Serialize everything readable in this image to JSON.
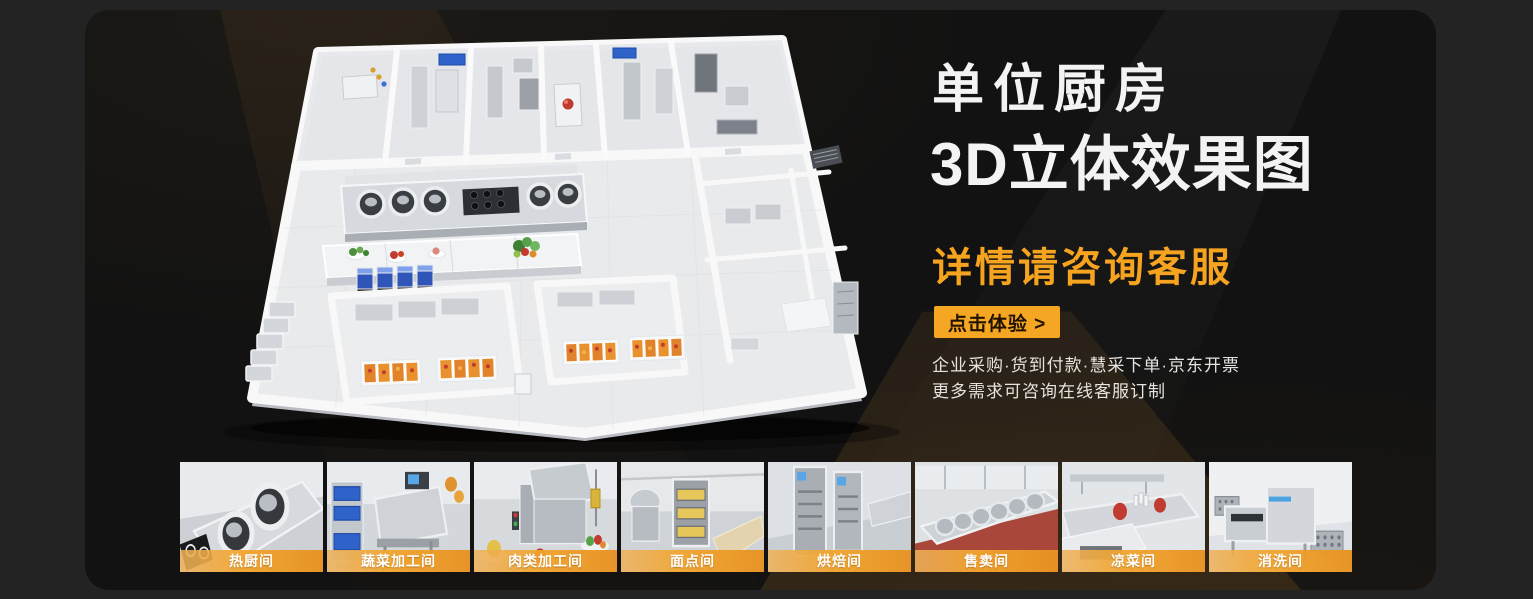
{
  "panel": {
    "title_line1": "单位厨房",
    "title_line2": "3D立体效果图",
    "subtitle": "详情请咨询客服",
    "cta_label": "点击体验 >",
    "desc_line1": "企业采购·货到付款·慧采下单·京东开票",
    "desc_line2": "更多需求可咨询在线客服订制"
  },
  "colors": {
    "accent_orange": "#F6A41F",
    "cta_text": "#221300",
    "panel_background": "#121212",
    "outer_background": "#232323",
    "title_text": "#F3F3F3",
    "desc_text": "#E6E3DE",
    "thumb_band_gradient": [
      "#EEB25C",
      "#E79221"
    ]
  },
  "icons": {
    "main_image": "isometric-3d-kitchen-floorplan",
    "thumbnails": "kitchen-room-render"
  },
  "thumbnails": [
    {
      "label": "热厨间"
    },
    {
      "label": "蔬菜加工间"
    },
    {
      "label": "肉类加工间"
    },
    {
      "label": "面点间"
    },
    {
      "label": "烘焙间"
    },
    {
      "label": "售卖间"
    },
    {
      "label": "凉菜间"
    },
    {
      "label": "消洗间"
    }
  ]
}
